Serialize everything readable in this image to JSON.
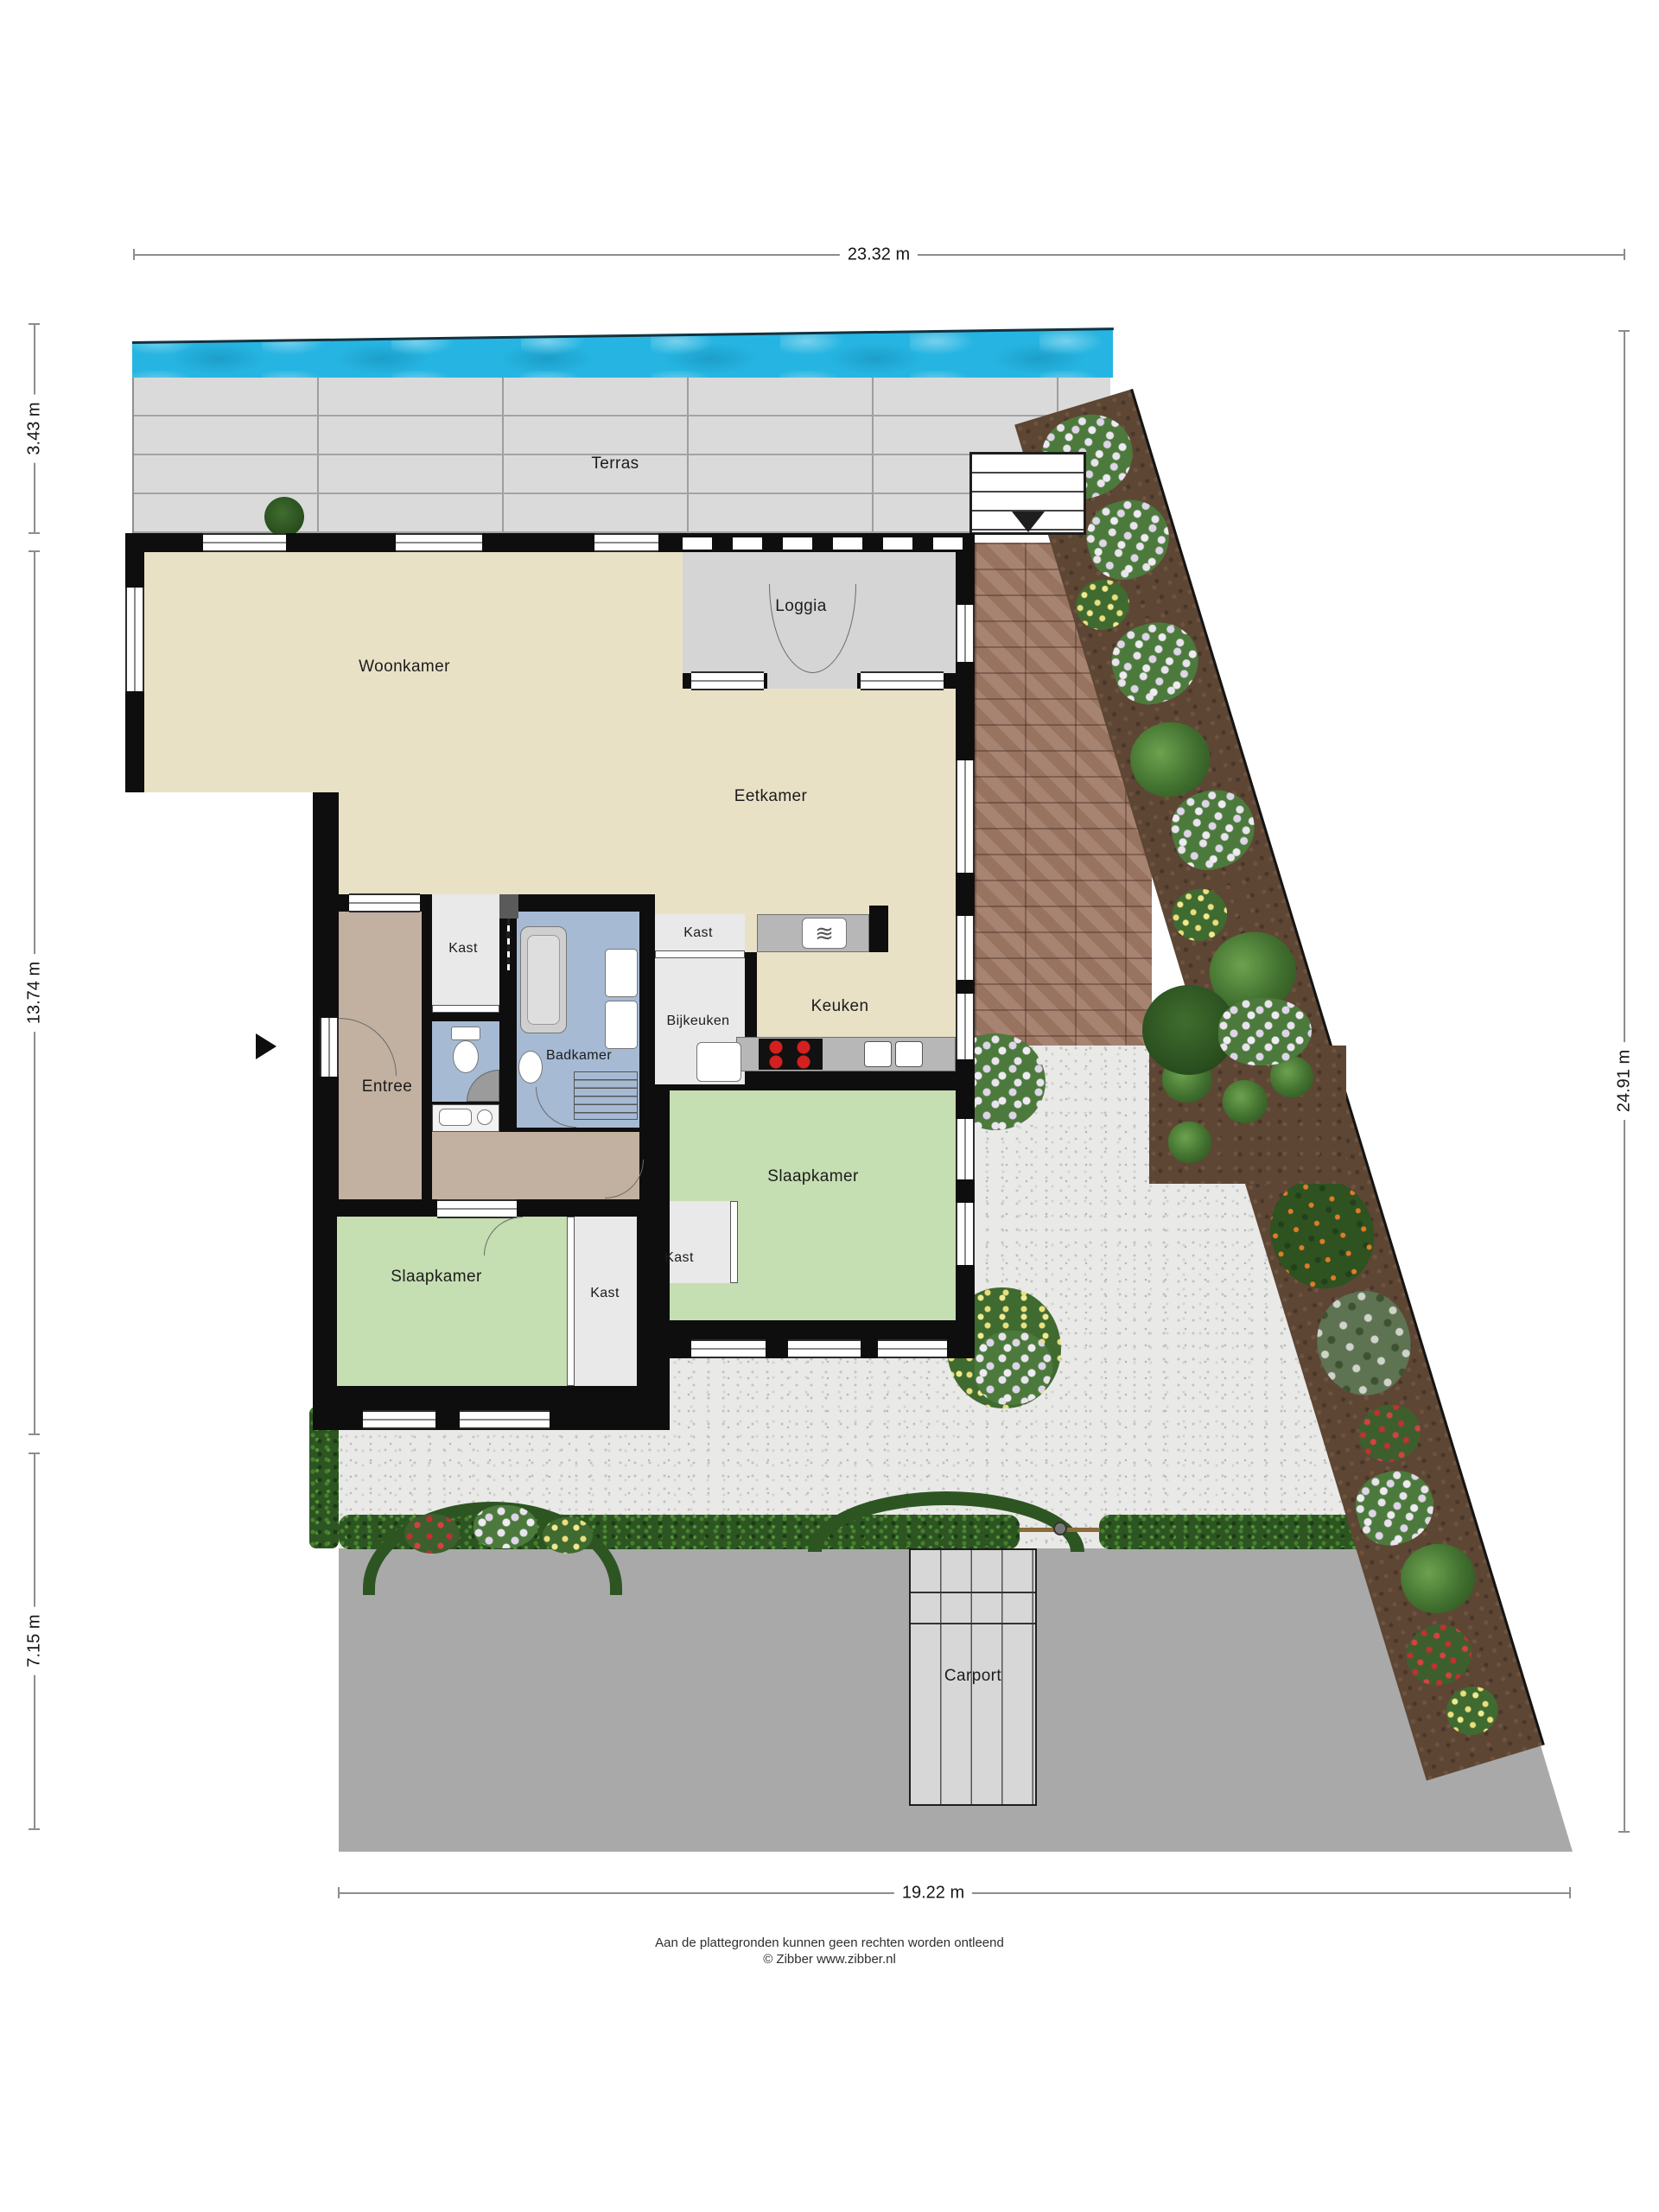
{
  "dimensions": {
    "top": "23.32 m",
    "left_top": "3.43 m",
    "left_middle": "13.74 m",
    "left_bottom": "7.15 m",
    "right": "24.91 m",
    "bottom": "19.22 m"
  },
  "rooms": {
    "terras": "Terras",
    "loggia": "Loggia",
    "woonkamer": "Woonkamer",
    "eetkamer": "Eetkamer",
    "kast_hal": "Kast",
    "k_niche": "K",
    "kast_keuken": "Kast",
    "badkamer": "Badkamer",
    "bijkeuken": "Bijkeuken",
    "keuken": "Keuken",
    "entree": "Entree",
    "slaapkamer_rechts": "Slaapkamer",
    "slaapkamer_links": "Slaapkamer",
    "kast_slaapkamer_rechts": "Kast",
    "kast_slaapkamer_links": "Kast",
    "carport": "Carport"
  },
  "footer": {
    "line1": "Aan de plattegronden kunnen geen rechten worden ontleend",
    "line2": "© Zibber www.zibber.nl"
  },
  "colors": {
    "pool_water": "#26b5e2",
    "floor_living": "#e9e1c6",
    "floor_hall": "#c2b1a0",
    "floor_bath": "#a6bad4",
    "floor_bedroom": "#c5deb2",
    "wall": "#0e0e0e",
    "brick_path": "#a07a66",
    "driveway": "#a9a9a9",
    "hedge": "#2d5522"
  }
}
